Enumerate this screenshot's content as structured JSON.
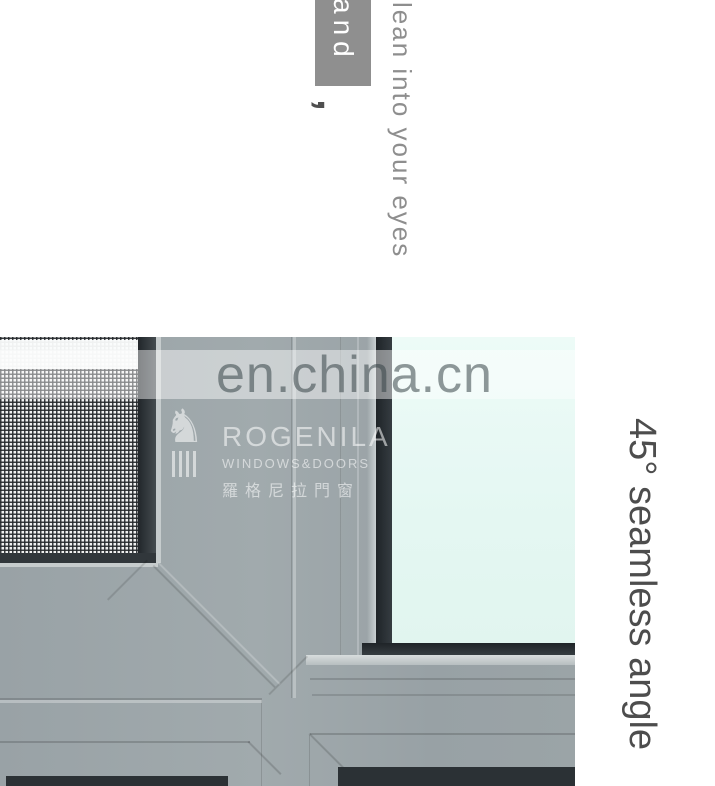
{
  "annotations": {
    "top_highlight_word": "and",
    "top_comma": ",",
    "top_phrase": "lean into your eyes",
    "side_caption": "45° seamless angle"
  },
  "watermark": {
    "site_text": "en.china.cn"
  },
  "logo": {
    "brand": "ROGENILA",
    "tagline": "WINDOWS&DOORS",
    "chinese_name": "羅格尼拉門窗",
    "icon": "lion-knight-on-column-icon"
  },
  "colors": {
    "highlight_box_gray": "#8f8f8f",
    "phrase_gray": "#8e8e8e",
    "caption_gray": "#4d4d4d",
    "frame_gray": "#9ba4a7",
    "gasket_dark": "#2c3236",
    "glass_tint": "#e6f8f4",
    "watermark_band": "rgba(255,255,255,0.45)"
  }
}
